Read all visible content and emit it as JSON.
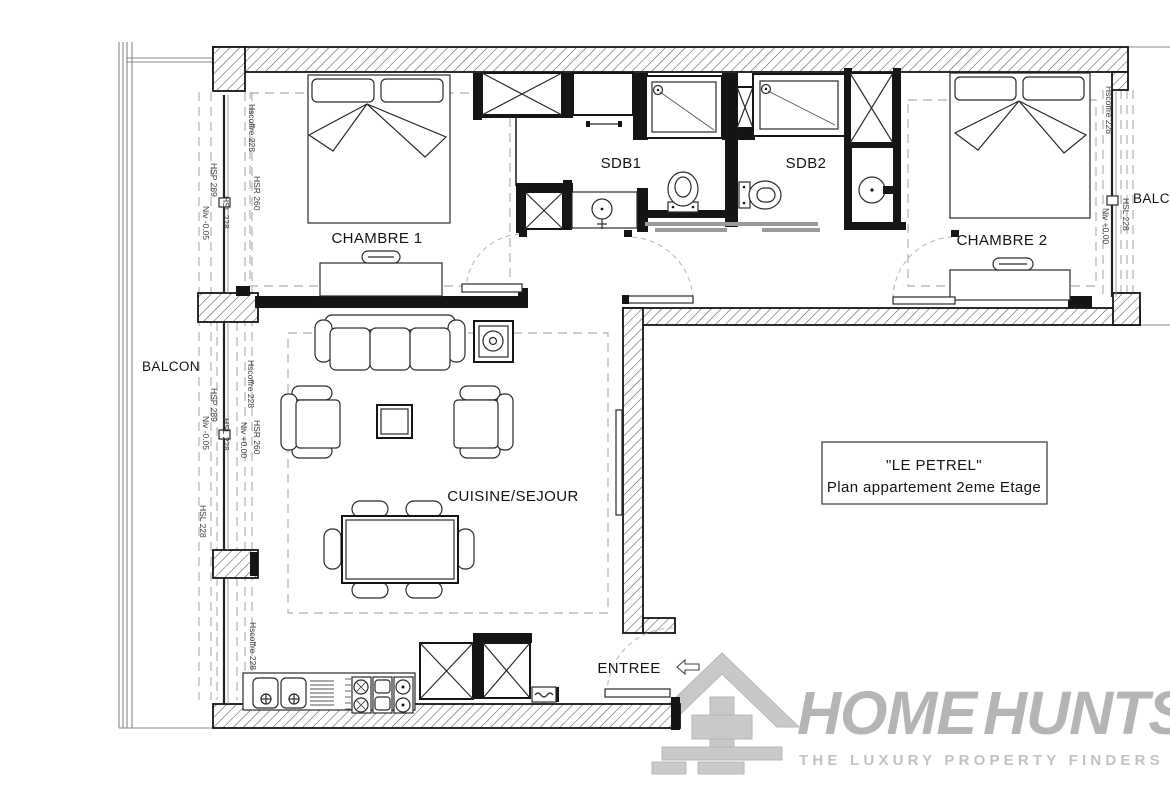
{
  "plan": {
    "rooms": {
      "chambre1": "CHAMBRE 1",
      "chambre2": "CHAMBRE 2",
      "sdb1": "SDB1",
      "sdb2": "SDB2",
      "cuisine_sejour": "CUISINE/SEJOUR",
      "entree": "ENTREE",
      "balcon_left": "BALCON",
      "balcon_right": "BALCON"
    },
    "title_box": {
      "line1": "\"LE PETREL\"",
      "line2": "Plan appartement 2eme Etage"
    },
    "annotations": [
      "Hscoffre 228",
      "HSP 289",
      "HSR 260",
      "HSL 228",
      "Niv -0.05",
      "Hscoffre 228",
      "HSP 289",
      "HSR 260",
      "HSL 228",
      "Niv +0.00",
      "Niv -0.05",
      "HSL 228",
      "Hscoffre 228",
      "Hscoffre 228",
      "Niv +0.00",
      "HSL 228"
    ]
  },
  "logo": {
    "brand_home": "HOME",
    "brand_hunts": "HUNTS",
    "tagline": "THE LUXURY PROPERTY FINDERS"
  },
  "colors": {
    "wall_black": "#151515",
    "hatch_line": "#555555",
    "logo_gray": "#b5b5b5",
    "tagline_gray": "#c2c2c2",
    "background": "#ffffff"
  }
}
